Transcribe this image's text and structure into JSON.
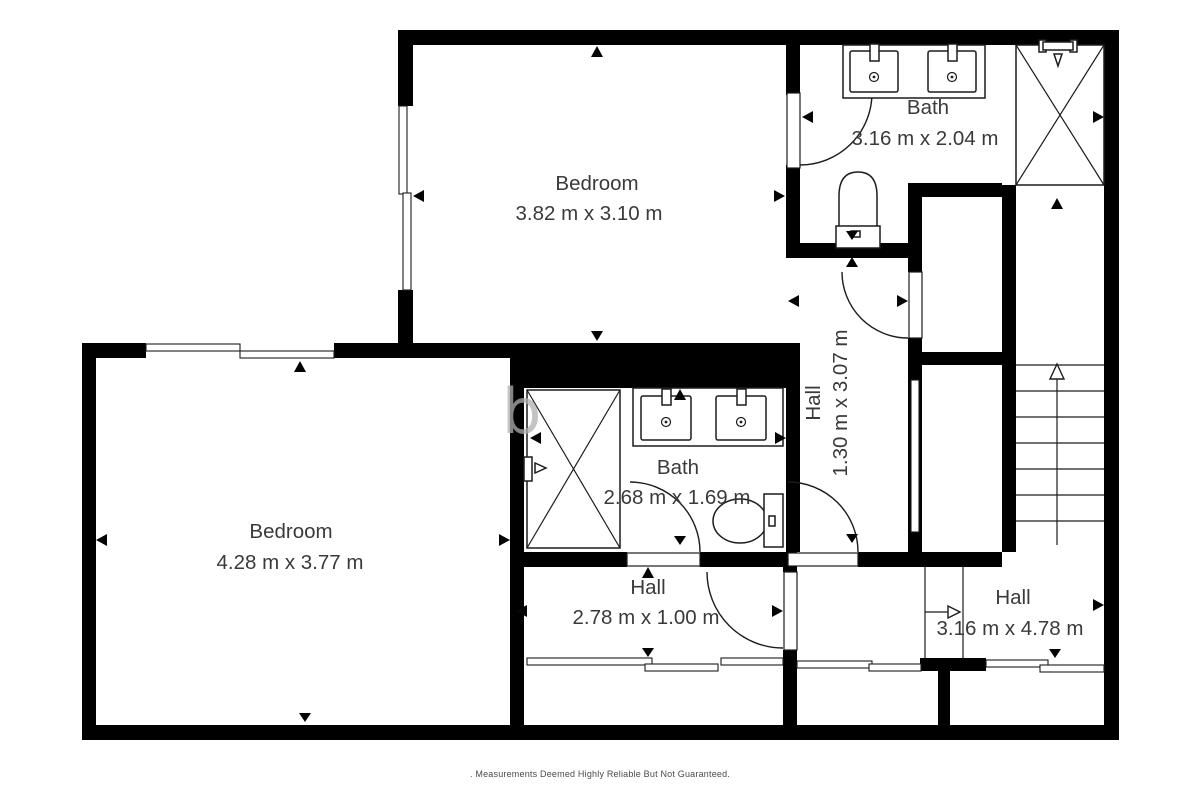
{
  "floorplan": {
    "rooms": {
      "bedroom_top": {
        "name": "Bedroom",
        "dims": "3.82 m x 3.10 m"
      },
      "bath_top": {
        "name": "Bath",
        "dims": "3.16 m x 2.04 m"
      },
      "bedroom_left": {
        "name": "Bedroom",
        "dims": "4.28 m x 3.77 m"
      },
      "bath_middle": {
        "name": "Bath",
        "dims": "2.68 m x 1.69 m"
      },
      "hall_vertical": {
        "name": "Hall",
        "dims": "1.30 m x 3.07 m"
      },
      "hall_bottom": {
        "name": "Hall",
        "dims": "2.78 m x 1.00 m"
      },
      "hall_right": {
        "name": "Hall",
        "dims": "3.16 m x 4.78 m"
      }
    },
    "watermark": "b",
    "footer": ". Measurements Deemed Highly Reliable But Not Guaranteed.",
    "colors": {
      "wall": "#000000",
      "line": "#1c1c1c",
      "text": "#3a3a3a",
      "footer_text": "#4b4b4b",
      "watermark": "#b0b0b0",
      "background": "#ffffff"
    }
  }
}
